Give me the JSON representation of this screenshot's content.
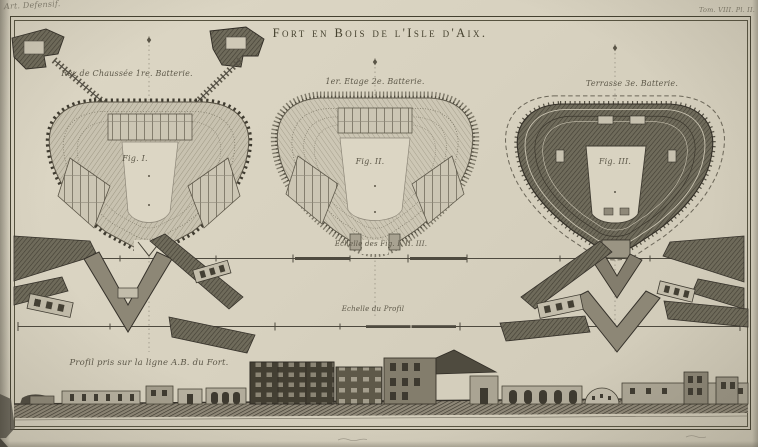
{
  "page": {
    "annotations": {
      "handwritten_note": "Art. Defensif.",
      "plate_ref": "Tom. VIII. Pl. II."
    },
    "title": "Fort en Bois de l'Isle d'Aix.",
    "figures": [
      {
        "caption": "Rez de Chaussée 1re. Batterie.",
        "label": "Fig. I."
      },
      {
        "caption": "1er. Etage 2e. Batterie.",
        "label": "Fig. II."
      },
      {
        "caption": "Terrasse 3e. Batterie.",
        "label": "Fig. III."
      }
    ],
    "scales": {
      "figures_scale_label": "Echelle des Fig. I. II. III.",
      "profile_scale_label": "Echelle du Profil"
    },
    "profile": {
      "caption": "Profil pris sur la ligne A.B. du Fort."
    },
    "colors": {
      "paper": "#d9d3c1",
      "ink_dark": "#3c382e",
      "ink_mid": "#6e6a5c",
      "ink_light": "#a8a292",
      "border": "#43402f"
    }
  }
}
